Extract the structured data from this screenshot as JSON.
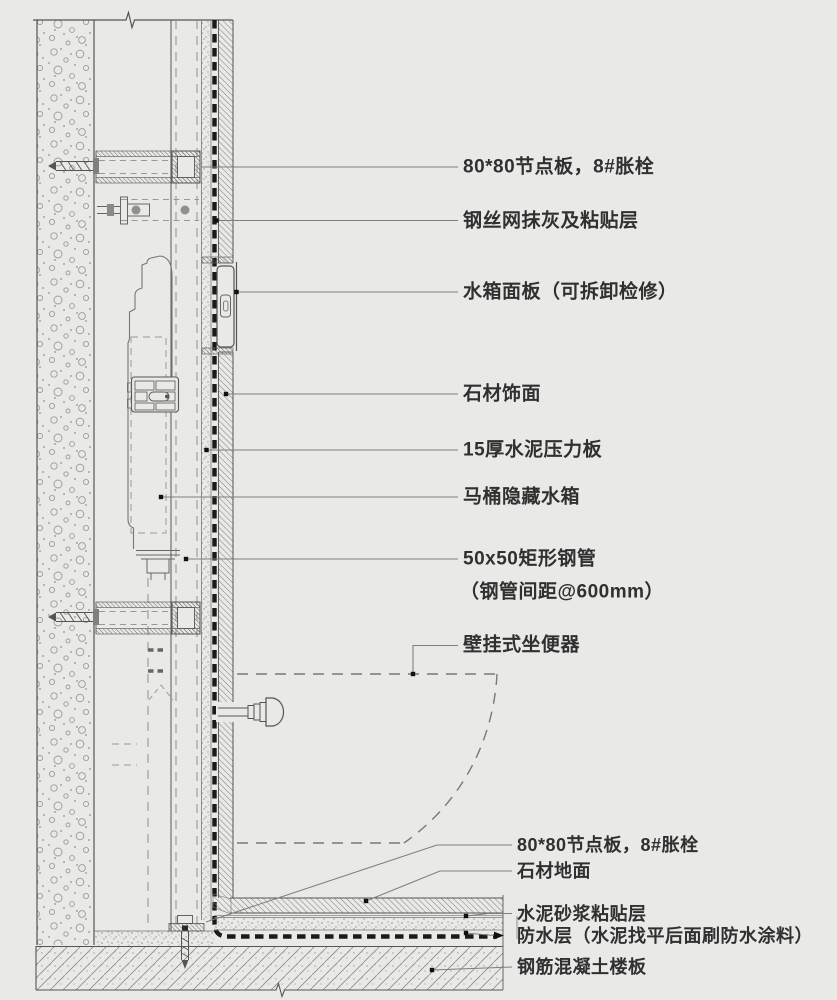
{
  "colors": {
    "background": "#e9e9e7",
    "line": "#555555",
    "membrane": "#1a1a1a",
    "text": "#303030"
  },
  "labels": [
    {
      "text": "80*80节点板，8#胀栓"
    },
    {
      "text": "钢丝网抹灰及粘贴层"
    },
    {
      "text": "水箱面板（可拆卸检修）"
    },
    {
      "text": "石材饰面"
    },
    {
      "text": "15厚水泥压力板"
    },
    {
      "text": "马桶隐藏水箱"
    },
    {
      "text": "50x50矩形钢管"
    },
    {
      "text": "（钢管间距@600mm）"
    },
    {
      "text": "壁挂式坐便器"
    },
    {
      "text": "80*80节点板，8#胀栓"
    },
    {
      "text": "石材地面"
    },
    {
      "text": "水泥砂浆粘贴层"
    },
    {
      "text": "防水层（水泥找平后面刷防水涂料）"
    },
    {
      "text": "钢筋混凝土楼板"
    }
  ]
}
